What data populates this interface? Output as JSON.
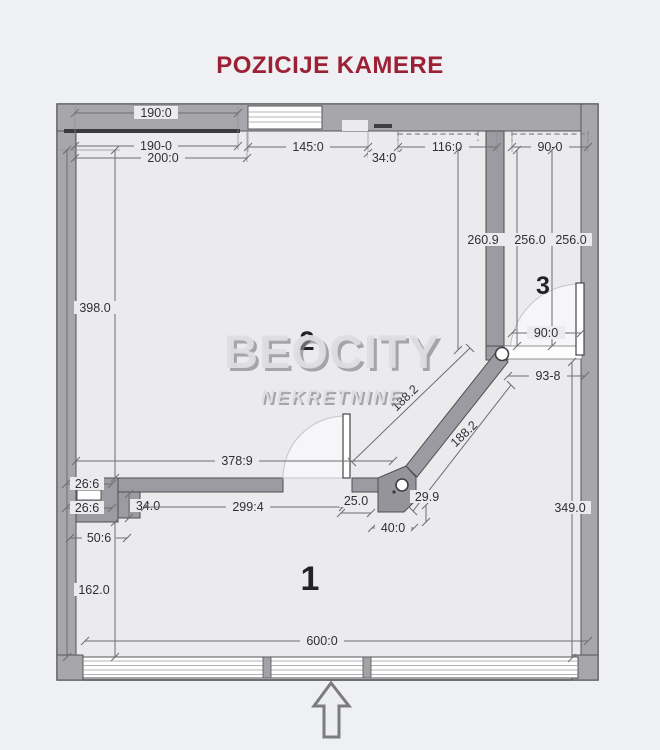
{
  "title": "POZICIJE KAMERE",
  "watermark": {
    "brand": "BEOCITY",
    "subtitle": "NEKRETNINE"
  },
  "rooms": {
    "room1": "1",
    "room2": "2",
    "room3": "3"
  },
  "dims": {
    "d190a": "190:0",
    "d190b": "190-0",
    "d200": "200:0",
    "d145": "145:0",
    "d34t": "34:0",
    "d116": "116:0",
    "d90t": "90-0",
    "d398": "398.0",
    "d2609": "260.9",
    "d256a": "256.0",
    "d256b": "256.0",
    "d90r3": "90:0",
    "d938": "93-8",
    "d188a": "188.2",
    "d188b": "188.2",
    "d3789": "378:9",
    "d266a": "26:6",
    "d266b": "26:6",
    "d340": "34.0",
    "d2994": "299:4",
    "d250": "25.0",
    "d299": "29.9",
    "d400": "40:0",
    "d506": "50:6",
    "d162": "162.0",
    "d600": "600:0",
    "d349": "349.0"
  },
  "colors": {
    "title": "#9c2135",
    "wall": "#a6a6ab",
    "floor": "#ebebed",
    "background": "#eff0f4"
  }
}
